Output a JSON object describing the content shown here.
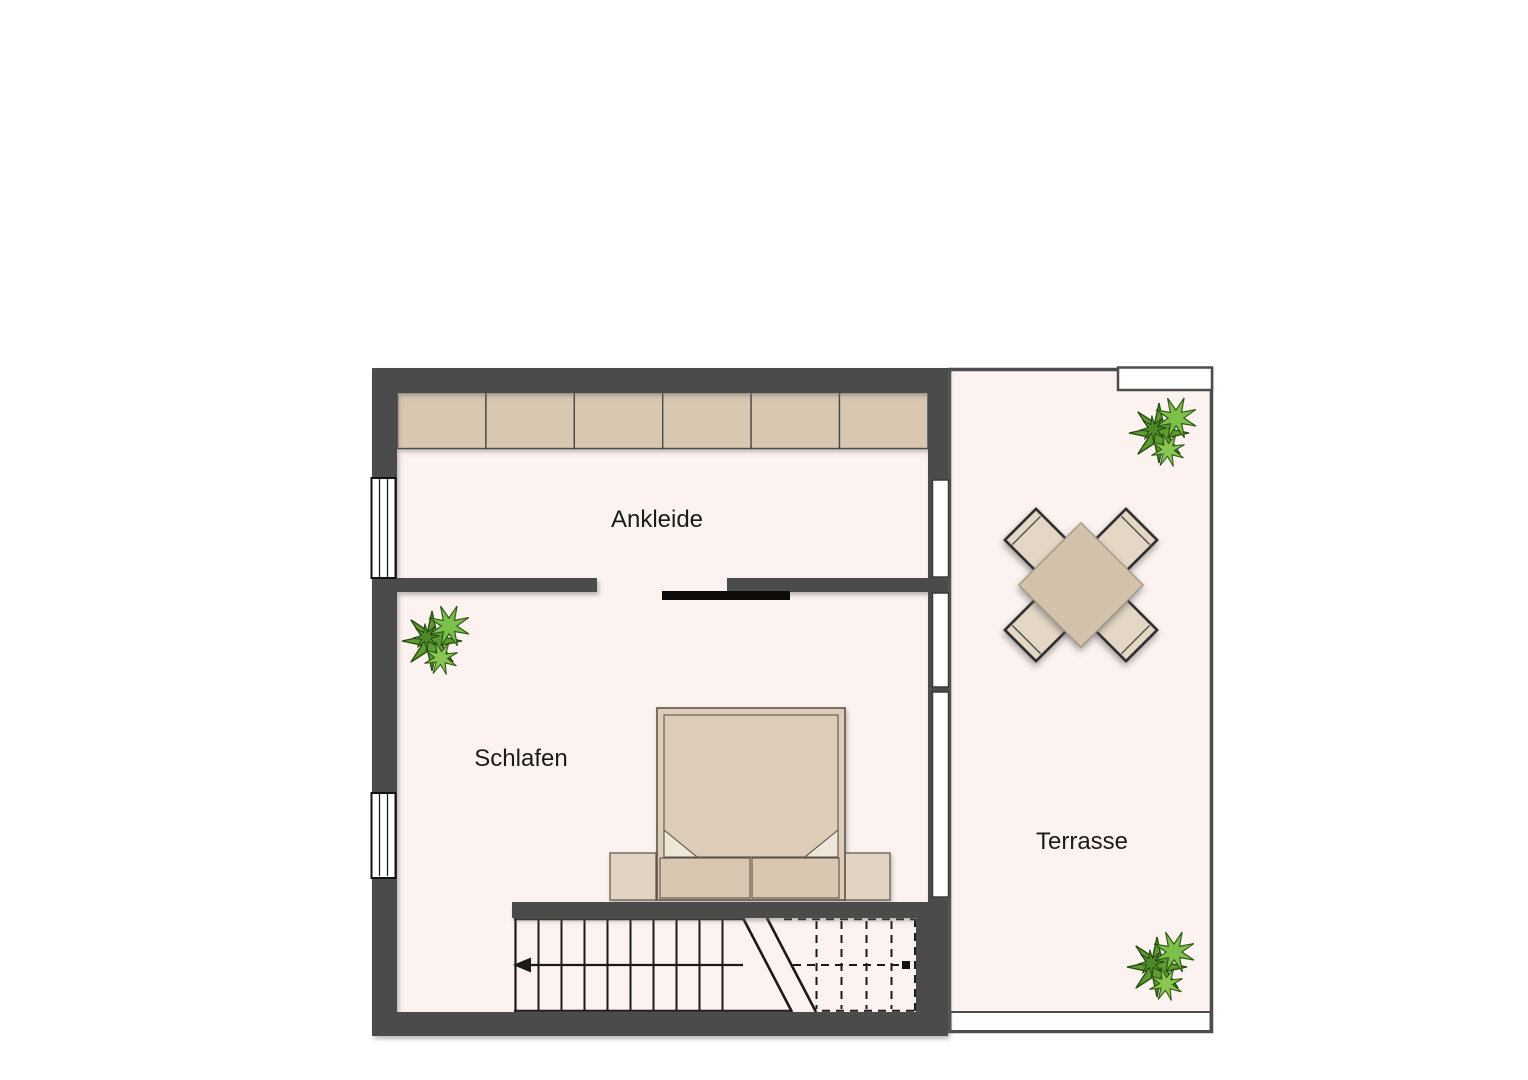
{
  "plan": {
    "type": "floor-plan",
    "floor_label_language": "de",
    "rooms": {
      "ankleide": {
        "label": "Ankleide"
      },
      "schlafen": {
        "label": "Schlafen"
      },
      "terrasse": {
        "label": "Terrasse"
      }
    },
    "furniture": {
      "wardrobe_unit_count": 6,
      "items": [
        "wardrobe-row",
        "double-bed",
        "nightstand-left",
        "nightstand-right",
        "pillow-left",
        "pillow-right",
        "dining-table",
        "chair x4",
        "staircase-with-break-line",
        "sliding-door"
      ],
      "plant_count": 3
    },
    "stairs": {
      "direction_arrow": "left",
      "solid_tread_count": 10,
      "dashed_tread_count": 4
    },
    "colors": {
      "wall": "#4b4b4b",
      "floor": "#fcf2ef",
      "furniture_tan": "#d8c8b2",
      "bed_tan": "#ddcdb8",
      "chair_tan": "#e4d7c5",
      "table_tan": "#d2c2ab",
      "sliding_door": "#0c0c0c",
      "plant_green": "#5e9c33",
      "line": "#1a1a1a",
      "background": "#ffffff"
    }
  }
}
